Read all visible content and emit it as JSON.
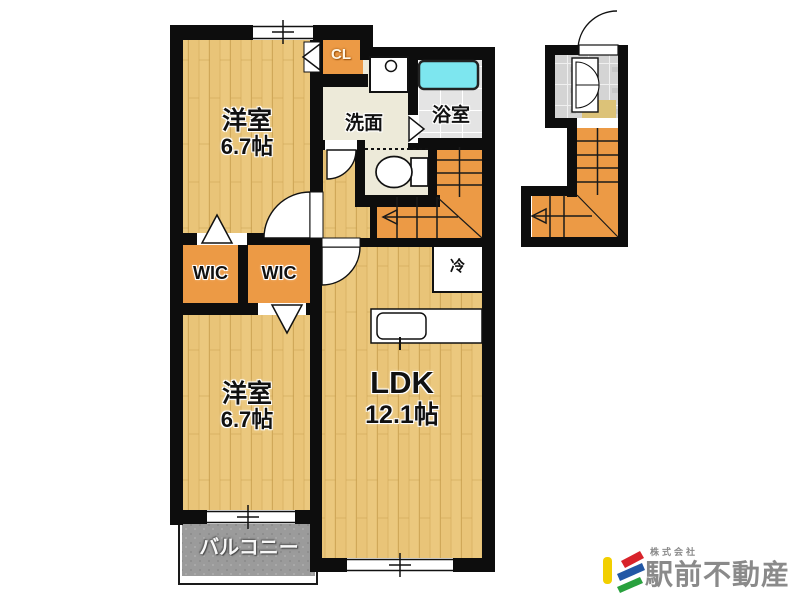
{
  "plan": {
    "rooms": {
      "bedroom_top": {
        "label": "洋室",
        "size": "6.7帖"
      },
      "bedroom_bottom": {
        "label": "洋室",
        "size": "6.7帖"
      },
      "ldk": {
        "label": "LDK",
        "size": "12.1帖"
      },
      "washroom": {
        "label": "洗面"
      },
      "bathroom": {
        "label": "浴室"
      },
      "closet": {
        "label": "CL"
      },
      "wic_left": {
        "label": "WIC"
      },
      "wic_right": {
        "label": "WIC"
      },
      "refrigerator": {
        "label": "冷"
      },
      "balcony": {
        "label": "バルコニー"
      }
    }
  },
  "branding": {
    "company_prefix": "株式会社",
    "company_name": "駅前不動産"
  },
  "palette": {
    "wall_black": "#0d0d0d",
    "wood_floor": "#ebc87e",
    "closet_orange": "#ec9a45",
    "stairs_orange": "#ec9a45",
    "bath_tile_gray": "#e4e4e4",
    "bathtub_cyan": "#7de6ef",
    "washroom_cream": "#edead9",
    "balcony_gray": "#9b9b9b",
    "entry_tile_gray": "#d4d4d4",
    "entry_step_tan": "#dcc278",
    "logo_yellow": "#f2cf00",
    "logo_red": "#d8232a",
    "logo_blue": "#2257a5",
    "logo_green": "#29a13e",
    "logo_text_gray": "#8a8a8a"
  }
}
